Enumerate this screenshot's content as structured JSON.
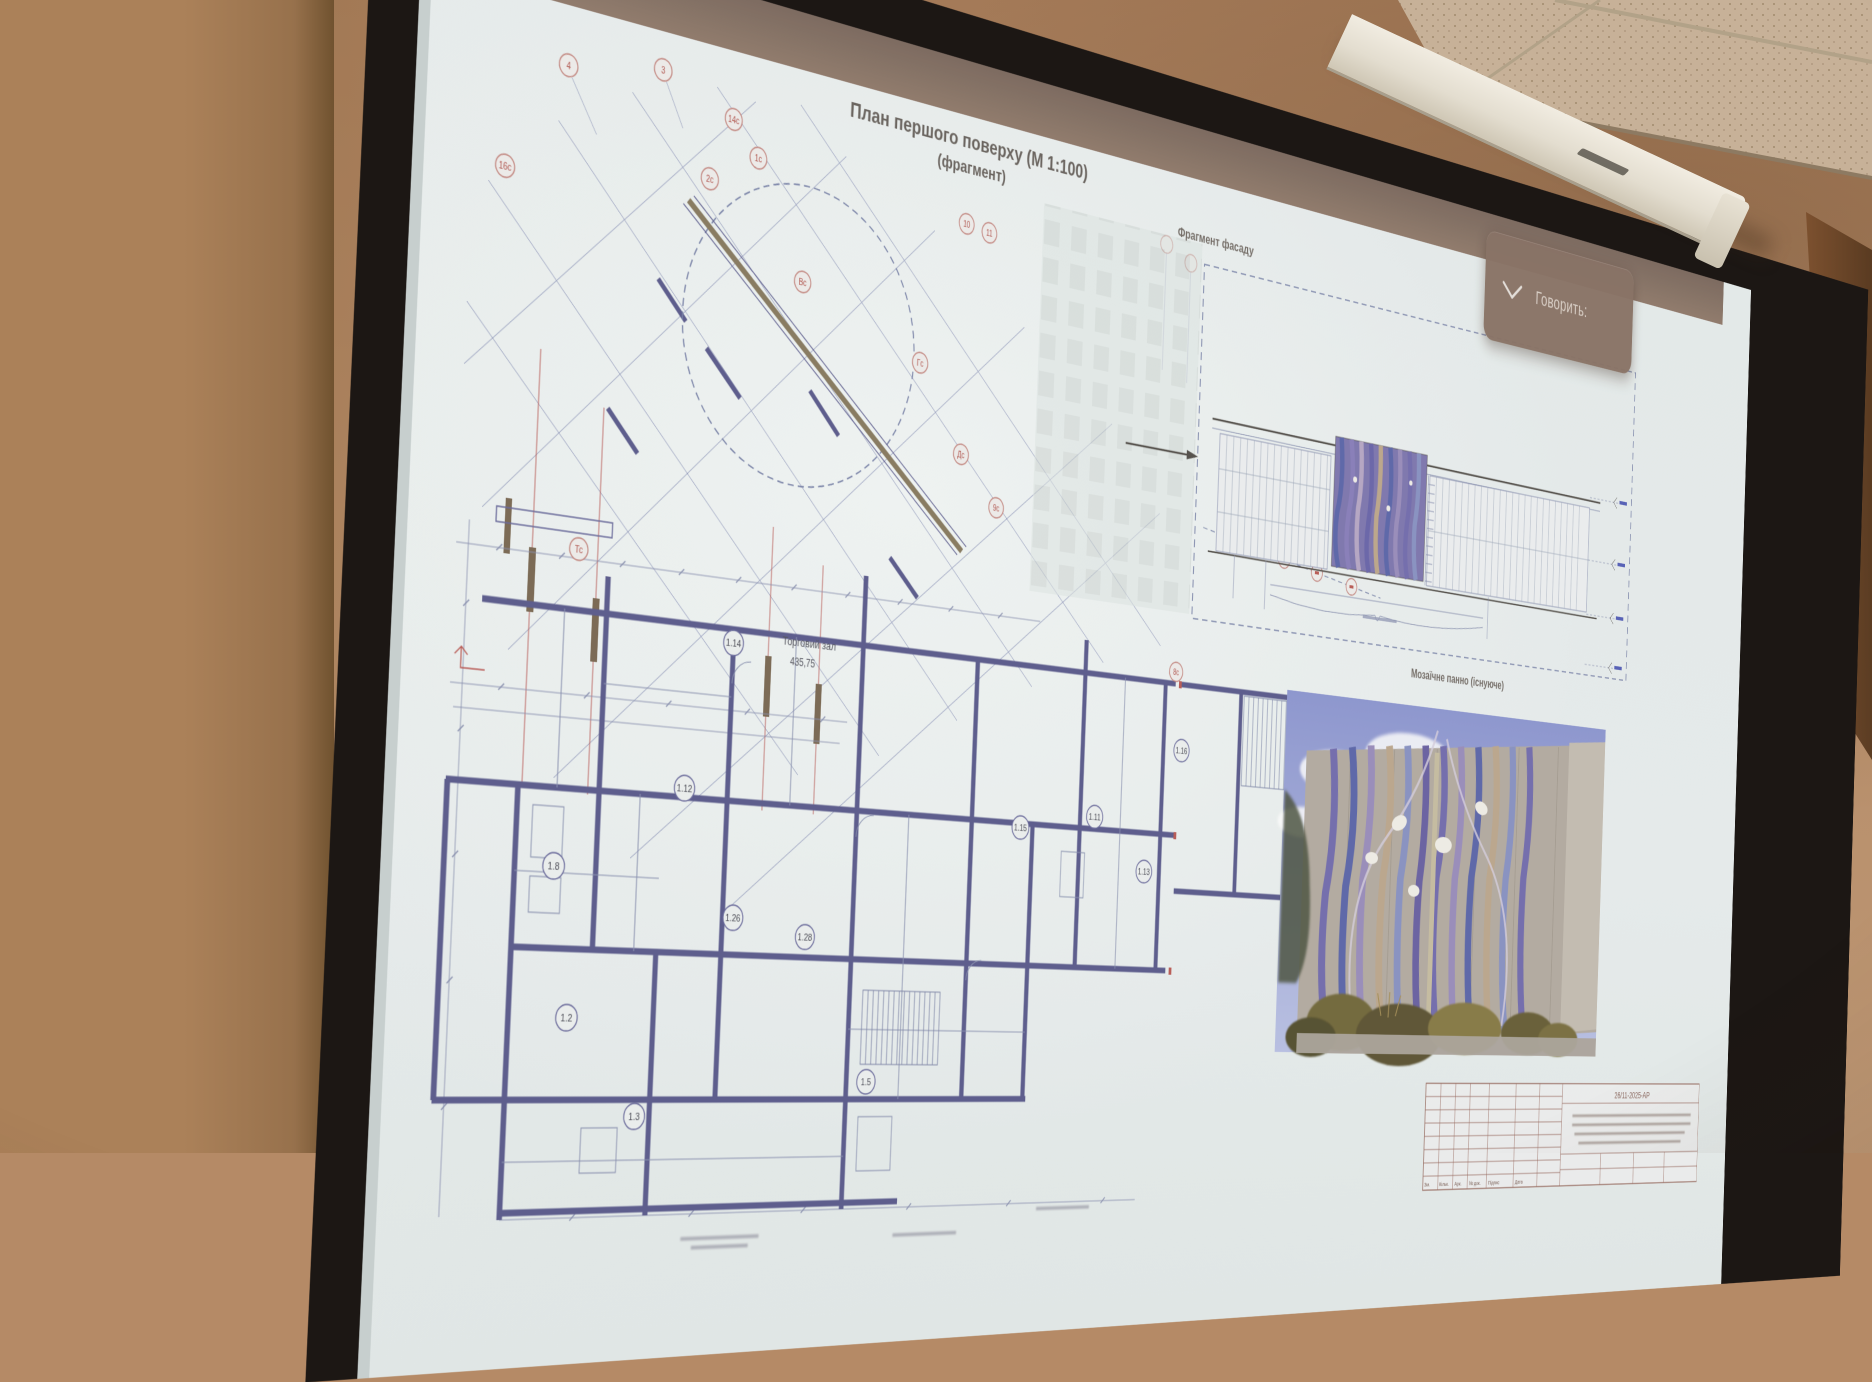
{
  "toast": {
    "label": "Говорить:"
  },
  "slide": {
    "title1": "План першого поверху (М 1:100)",
    "title2": "(фрагмент)",
    "facade_caption": "Фрагмент фасаду",
    "mosaic_caption": "Мозаїчне панно (існуюче)"
  },
  "plan": {
    "axis_labels": [
      "4",
      "3",
      "14с",
      "1с",
      "2с",
      "16с",
      "10",
      "11",
      "Вс",
      "Гс",
      "Дс",
      "9с",
      "8с",
      "Тс"
    ],
    "rooms": [
      {
        "num": "1.14",
        "name": "Торговий зал",
        "area": "435,75"
      },
      {
        "num": "1.12"
      },
      {
        "num": "1.16"
      },
      {
        "num": "1.15"
      },
      {
        "num": "1.13"
      },
      {
        "num": "1.11"
      },
      {
        "num": "1.8"
      },
      {
        "num": "1.26"
      },
      {
        "num": "1.28"
      },
      {
        "num": "1.2"
      },
      {
        "num": "1.3"
      },
      {
        "num": "1.5"
      }
    ]
  },
  "titleblock": {
    "doc_number": "26/11-2025-АР",
    "columns": [
      "Зм.",
      "Кільк.",
      "Арк.",
      "№ док.",
      "Підпис",
      "Дата"
    ]
  },
  "palette": {
    "accent_red": "#c25b54",
    "plan_wall_blue": "#5c5c92",
    "toast_bg": "#8a7263",
    "screen_white": "#e9efee",
    "wall_tan": "#b58a66",
    "sky_blue": "#8e98d6",
    "mosaic_purple": "#756eb4"
  }
}
